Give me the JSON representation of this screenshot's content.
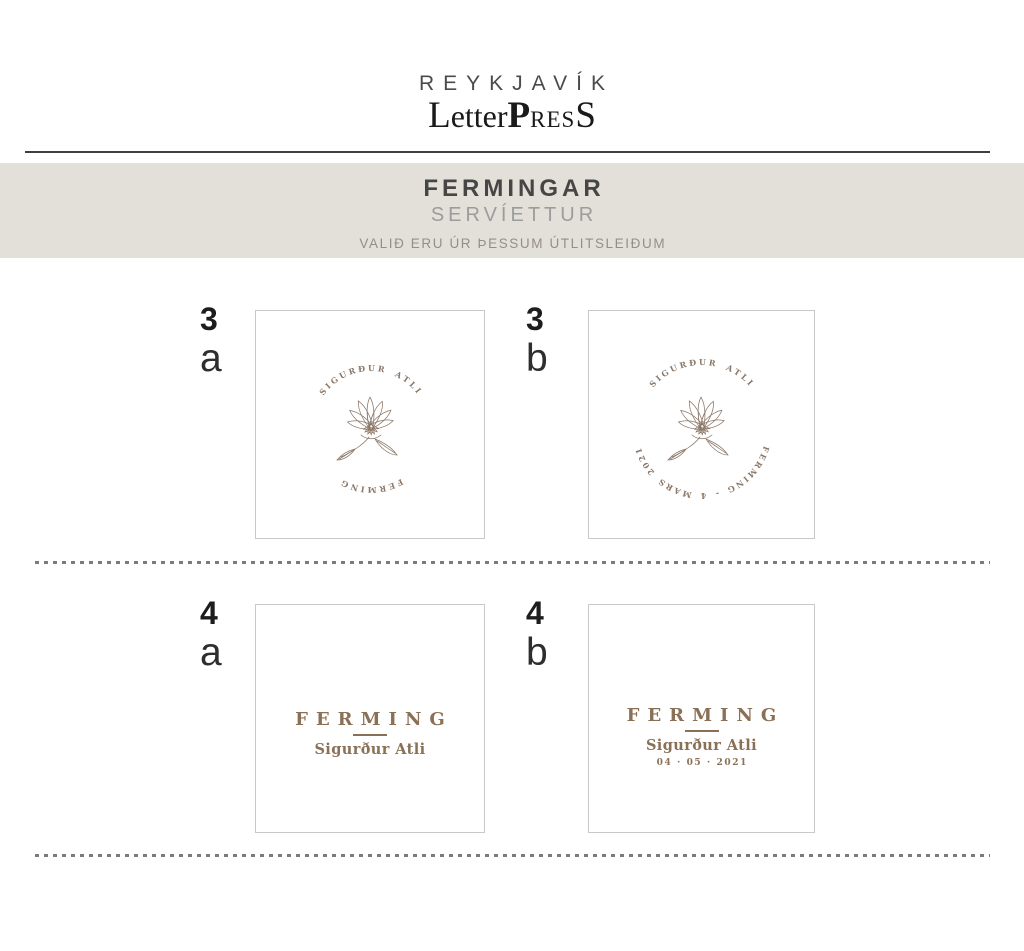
{
  "colors": {
    "banner-bg": "#e3e0da",
    "brown": "#8a7156",
    "arc-brown": "#8b7767",
    "title-dark": "#464646",
    "subtitle-gray": "#9c9c9c",
    "note-gray": "#968e86",
    "border-gray": "#c9c9c9",
    "dot-gray": "#7b7b7b",
    "rule-dark": "#3f3f3f",
    "logo-gray": "#4b4b4b",
    "label-dark": "#1d1d1d"
  },
  "logo": {
    "line1": "REYKJAVÍK",
    "mark": {
      "l": "L",
      "etter": "etter",
      "p": "P",
      "res": "res",
      "s": "S"
    }
  },
  "banner": {
    "title": "FERMINGAR",
    "subtitle": "SERVÍETTUR",
    "note": "VALIÐ ERU ÚR ÞESSUM ÚTLITSLEIÐUM"
  },
  "swatches": [
    {
      "number": "3",
      "letter": "a",
      "arc_top": "SIGURÐUR ATLI",
      "arc_bottom": "FERMING"
    },
    {
      "number": "3",
      "letter": "b",
      "arc_top": "SIGURÐUR ATLI",
      "arc_bottom": "FERMING - 4 MARS 2021"
    },
    {
      "number": "4",
      "letter": "a",
      "title": "FERMING",
      "name": "Sigurður Atli"
    },
    {
      "number": "4",
      "letter": "b",
      "title": "FERMING",
      "name": "Sigurður Atli",
      "date": "04 · 05 · 2021"
    }
  ]
}
